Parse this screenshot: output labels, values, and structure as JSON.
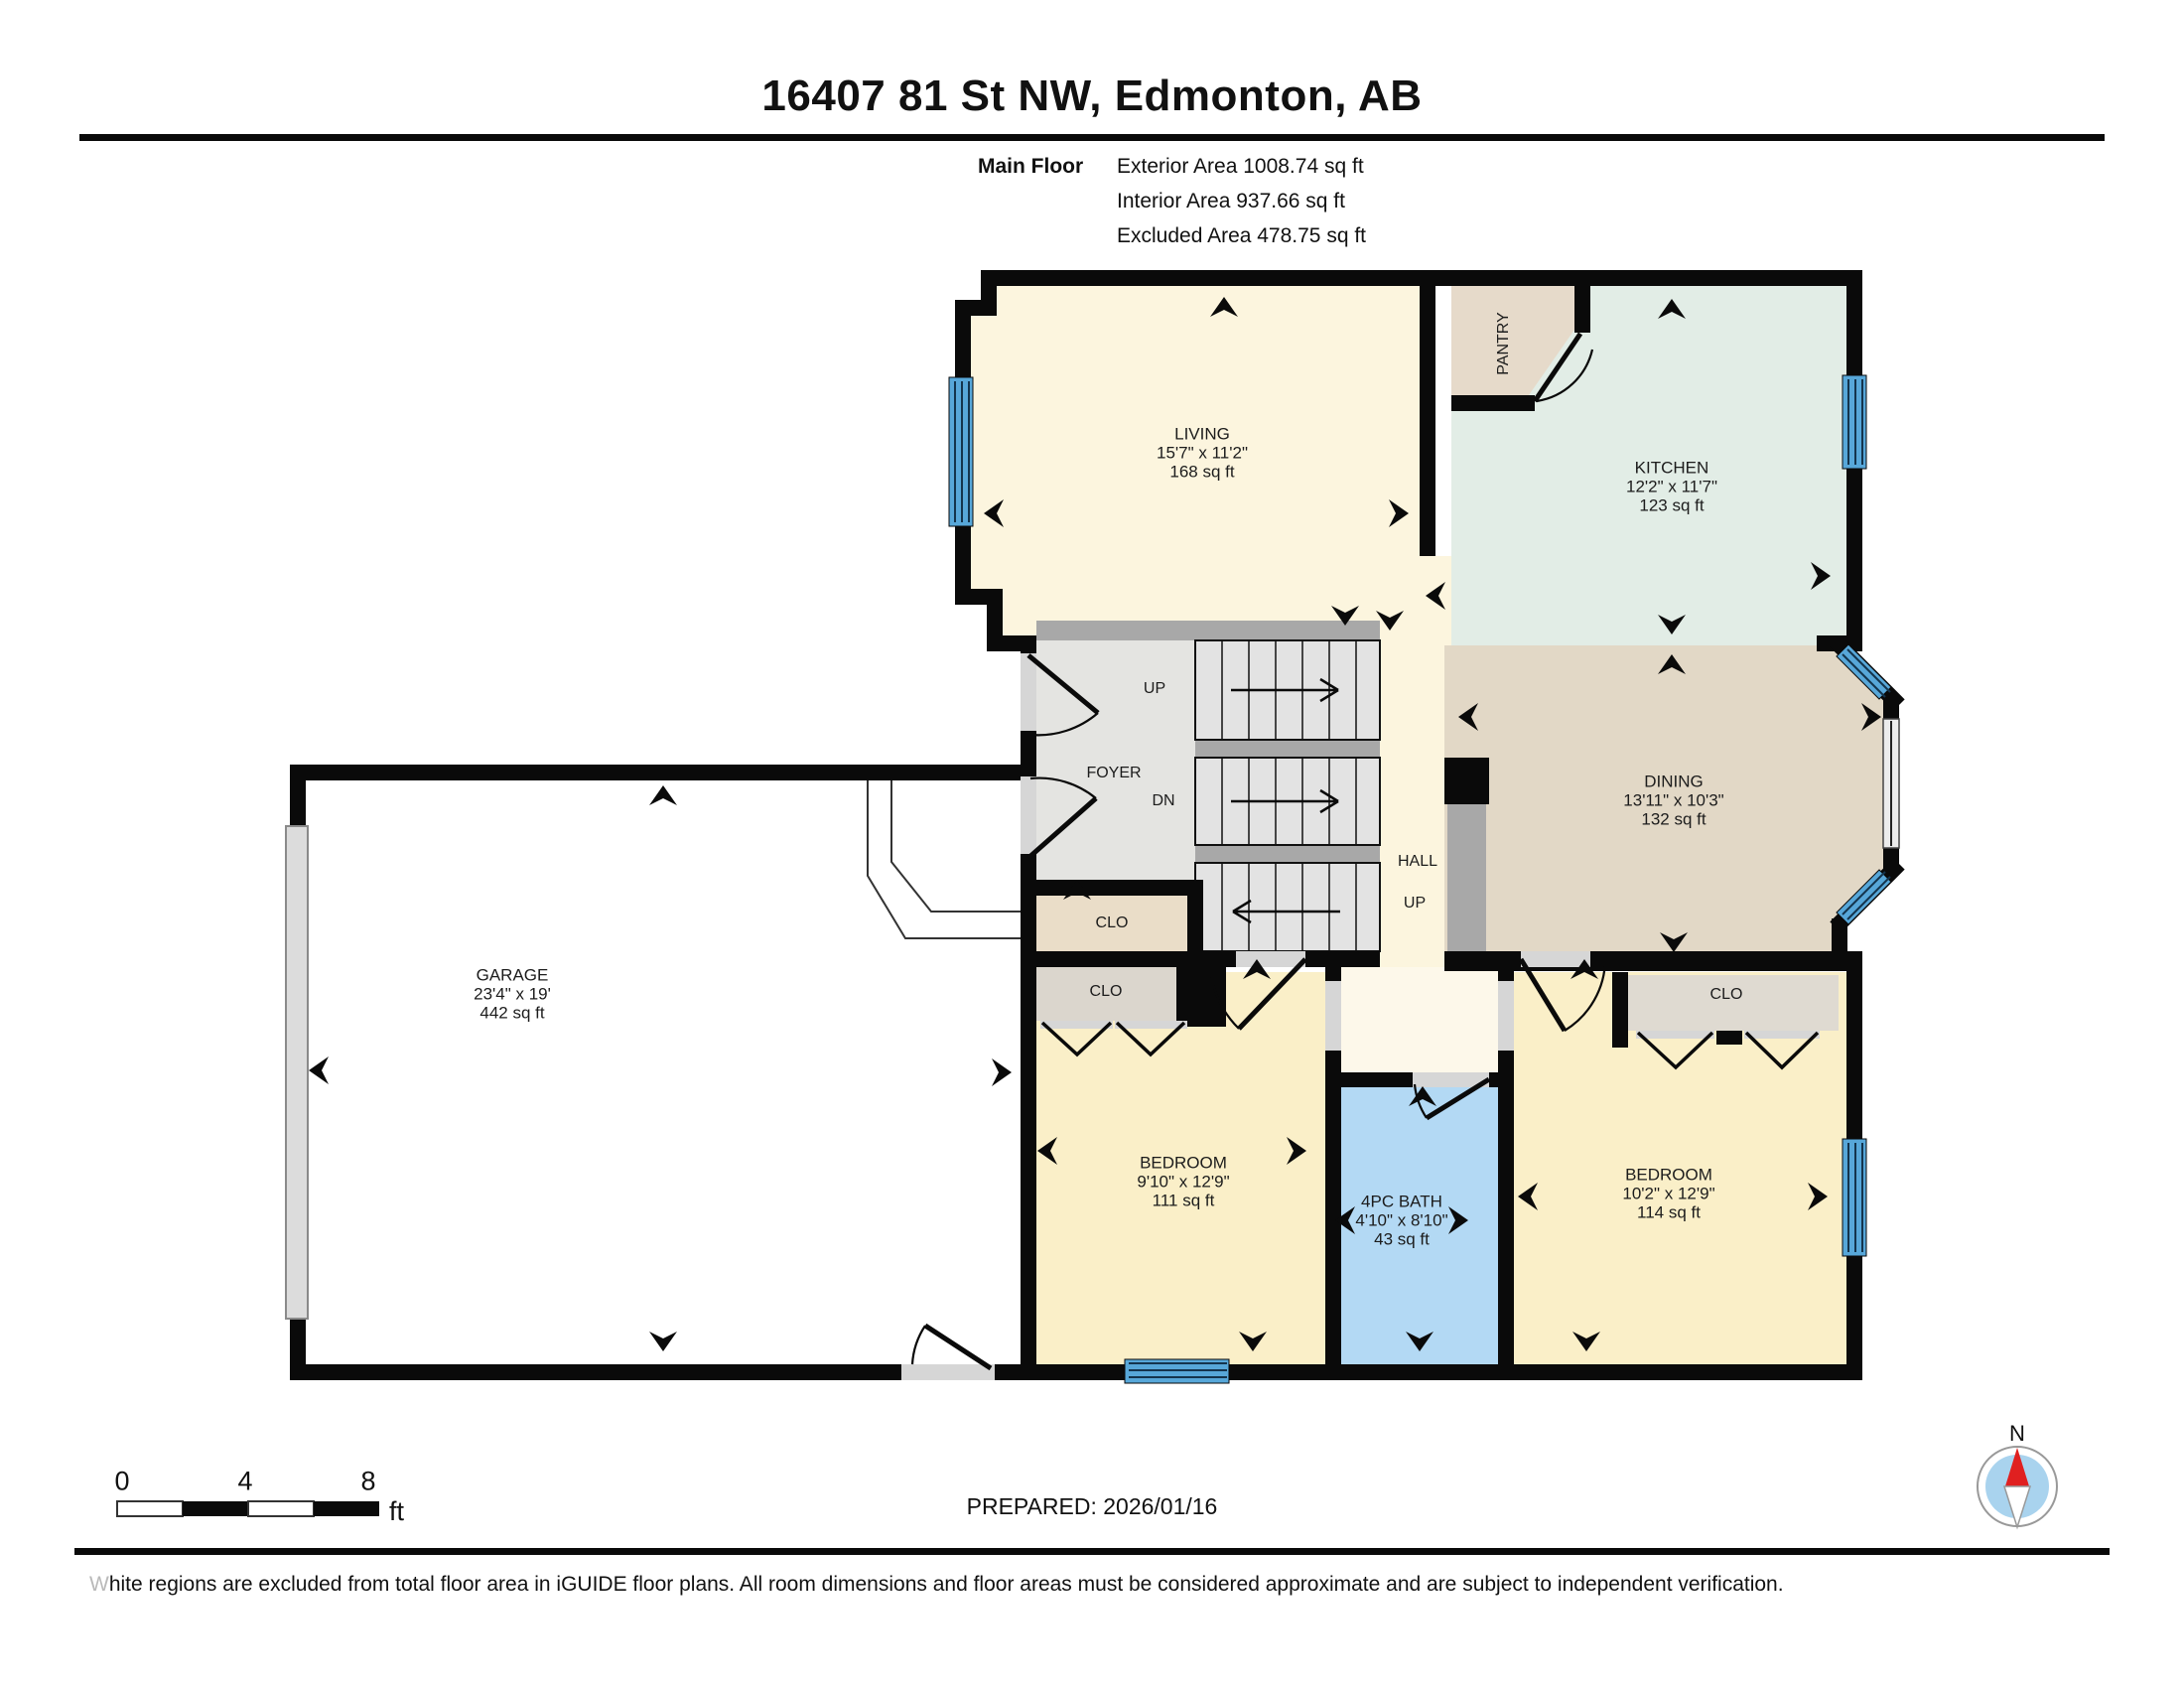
{
  "header": {
    "title": "16407 81 St NW, Edmonton, AB",
    "floor_label": "Main Floor",
    "area_lines": [
      "Exterior Area 1008.74 sq ft",
      "Interior Area 937.66 sq ft",
      "Excluded Area 478.75 sq ft"
    ]
  },
  "rooms": {
    "living": {
      "name": "LIVING",
      "dims": "15'7\" x 11'2\"",
      "area": "168 sq ft"
    },
    "kitchen": {
      "name": "KITCHEN",
      "dims": "12'2\" x 11'7\"",
      "area": "123 sq ft"
    },
    "dining": {
      "name": "DINING",
      "dims": "13'11\" x 10'3\"",
      "area": "132 sq ft"
    },
    "garage": {
      "name": "GARAGE",
      "dims": "23'4\" x 19'",
      "area": "442 sq ft"
    },
    "bedroom1": {
      "name": "BEDROOM",
      "dims": "9'10\" x 12'9\"",
      "area": "111 sq ft"
    },
    "bath": {
      "name": "4PC BATH",
      "dims": "4'10\" x 8'10\"",
      "area": "43 sq ft"
    },
    "bedroom2": {
      "name": "BEDROOM",
      "dims": "10'2\" x 12'9\"",
      "area": "114 sq ft"
    },
    "pantry": {
      "name": "PANTRY"
    },
    "foyer": {
      "name": "FOYER"
    },
    "hall": {
      "name": "HALL"
    },
    "closet1": {
      "name": "CLO"
    },
    "closet2": {
      "name": "CLO"
    },
    "closet3": {
      "name": "CLO"
    }
  },
  "stairs": {
    "up_label": "UP",
    "down_label": "DN",
    "hall_up_label": "UP"
  },
  "scale_bar": {
    "tick0": "0",
    "tick4": "4",
    "tick8": "8",
    "unit": "ft"
  },
  "prepared": "PREPARED: 2026/01/16",
  "compass": {
    "north_label": "N"
  },
  "footer": {
    "lead": "W",
    "rest": "hite regions are excluded from total floor area in iGUIDE floor plans. All room dimensions and floor areas must be considered approximate and are subject to independent verification."
  },
  "colors": {
    "wall": "#0a0a0a",
    "living": "#FCF5DE",
    "bedroom": "#FAEFC8",
    "vestibule": "#FDF8EA",
    "kitchen": "#E2EDE6",
    "dining": "#E2D8C6",
    "pantry": "#E6DACA",
    "foyer": "#E4E4E1",
    "stairs": "#E3E3E3",
    "landing": "#A8A8A8",
    "closet_tan": "#EADDC8",
    "closet_gray": "#DBD6CD",
    "bath": "#B3D9F4",
    "window": "#57A7D9",
    "garage_door": "#DCDCDC",
    "compass_red": "#E02020",
    "compass_blue": "#A9D3EE"
  }
}
